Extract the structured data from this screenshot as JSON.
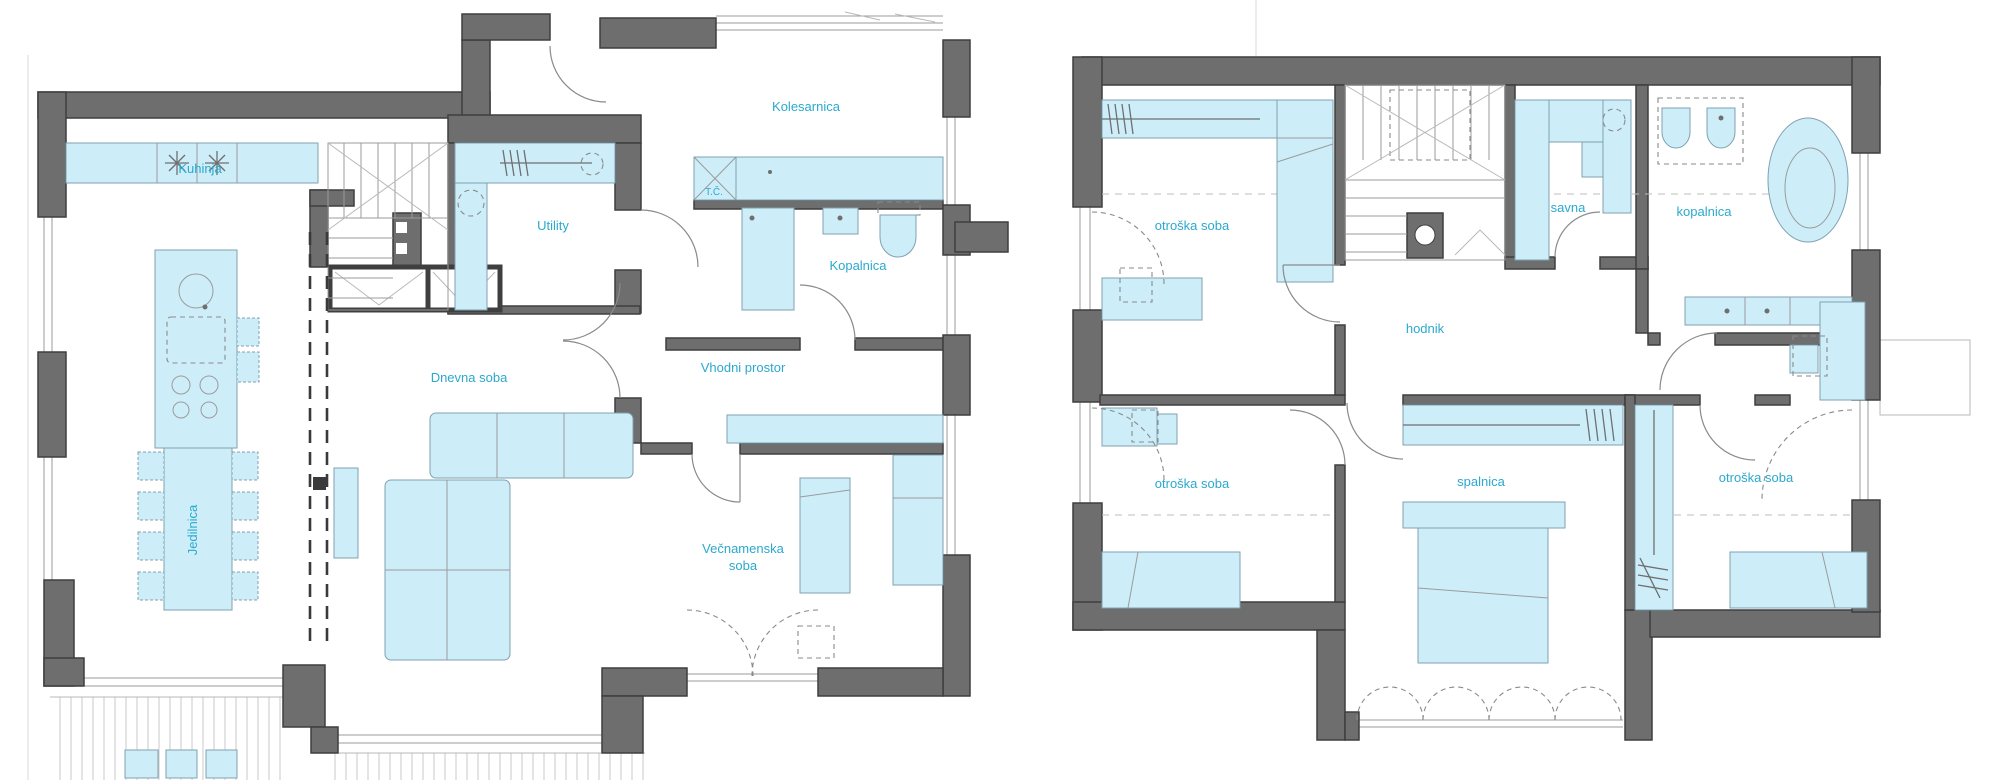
{
  "colors": {
    "wall": "#6E6E6E",
    "wall_outline": "#3F3F3F",
    "furniture_fill": "#CDEEF9",
    "furniture_stroke": "#7FA2B0",
    "label": "#2BA9CE"
  },
  "left_plan": {
    "rooms": [
      {
        "id": "kuhinja",
        "label": "Kuhinja"
      },
      {
        "id": "jedilnica",
        "label": "Jedilnica"
      },
      {
        "id": "utility",
        "label": "Utility"
      },
      {
        "id": "kolesarnica",
        "label": "Kolesarnica"
      },
      {
        "id": "toplotna-crpalka",
        "label": "T.Č."
      },
      {
        "id": "kopalnica",
        "label": "Kopalnica"
      },
      {
        "id": "vhodni-prostor",
        "label": "Vhodni prostor"
      },
      {
        "id": "dnevna-soba",
        "label": "Dnevna soba"
      },
      {
        "id": "vecnamenska-soba",
        "lines": [
          "Večnamenska",
          "soba"
        ]
      }
    ]
  },
  "right_plan": {
    "rooms": [
      {
        "id": "otroska-soba-nw",
        "label": "otroška soba"
      },
      {
        "id": "savna",
        "label": "savna"
      },
      {
        "id": "kopalnica",
        "label": "kopalnica"
      },
      {
        "id": "hodnik",
        "label": "hodnik"
      },
      {
        "id": "otroska-soba-sw",
        "label": "otroška soba"
      },
      {
        "id": "spalnica",
        "label": "spalnica"
      },
      {
        "id": "otroska-soba-se",
        "label": "otroška soba"
      }
    ]
  }
}
